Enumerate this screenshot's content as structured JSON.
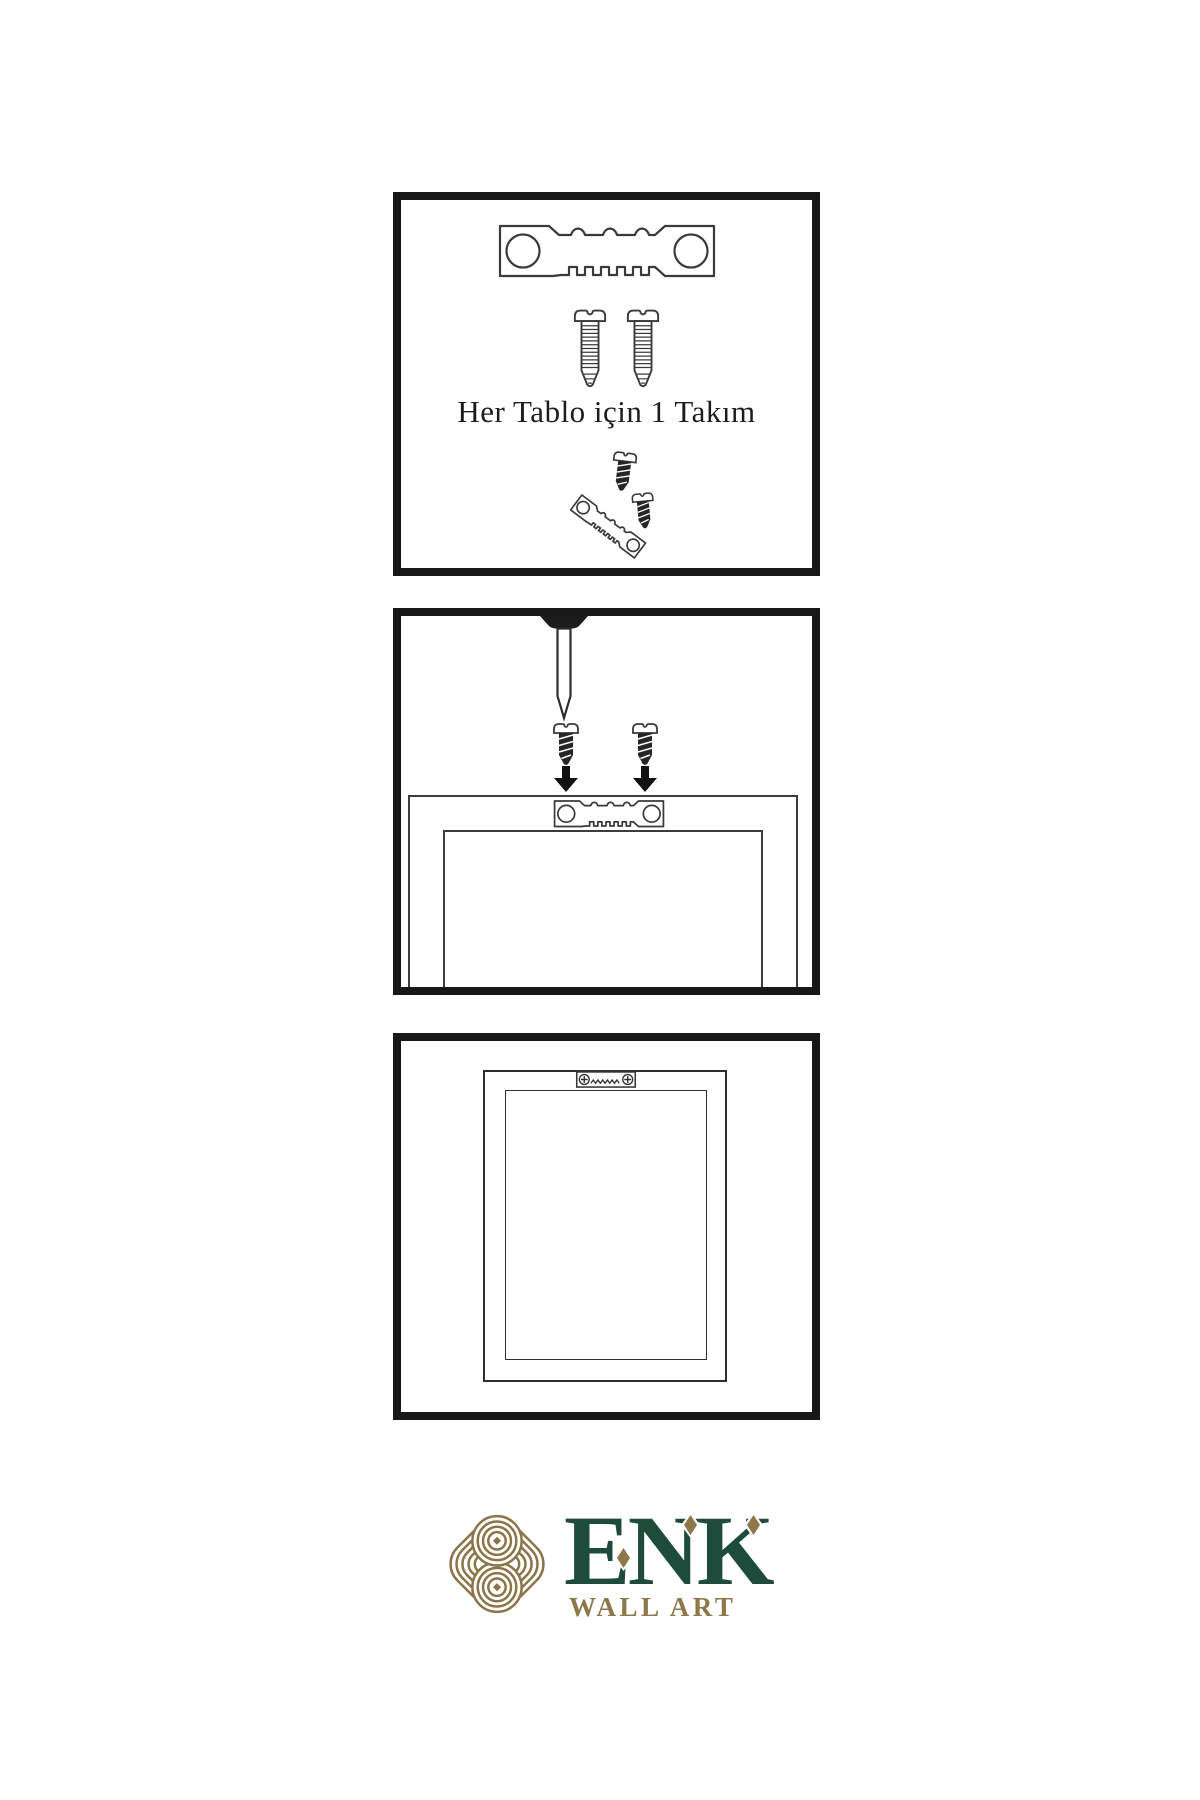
{
  "page": {
    "background": "#ffffff",
    "width_px": 1200,
    "height_px": 1800
  },
  "panels": [
    {
      "name": "hardware-kit",
      "caption": "Her Tablo için 1 Takım",
      "icons": [
        "sawtooth-hanger-icon",
        "screw-icon",
        "screw-icon",
        "tilted-sawtooth-hanger-with-screws-icon"
      ]
    },
    {
      "name": "installation-step",
      "icons": [
        "wall-nail-icon",
        "screw-icon",
        "screw-icon",
        "down-arrow-icon",
        "down-arrow-icon",
        "sawtooth-hanger-icon",
        "frame-back-icon"
      ]
    },
    {
      "name": "mounted-result",
      "icons": [
        "frame-back-icon",
        "mounted-sawtooth-hanger-with-screws-icon"
      ]
    }
  ],
  "logo": {
    "brand": "ENK",
    "subtitle": "WALL ART",
    "emblem": "celtic-knot-icon",
    "colors": {
      "green": "#1e4b3a",
      "gold": "#8c7848",
      "knot": "#8a7548"
    }
  },
  "illustration_colors": {
    "line": "#3a3a3a",
    "panel_border": "#181818",
    "dark_metal": "#262626"
  }
}
